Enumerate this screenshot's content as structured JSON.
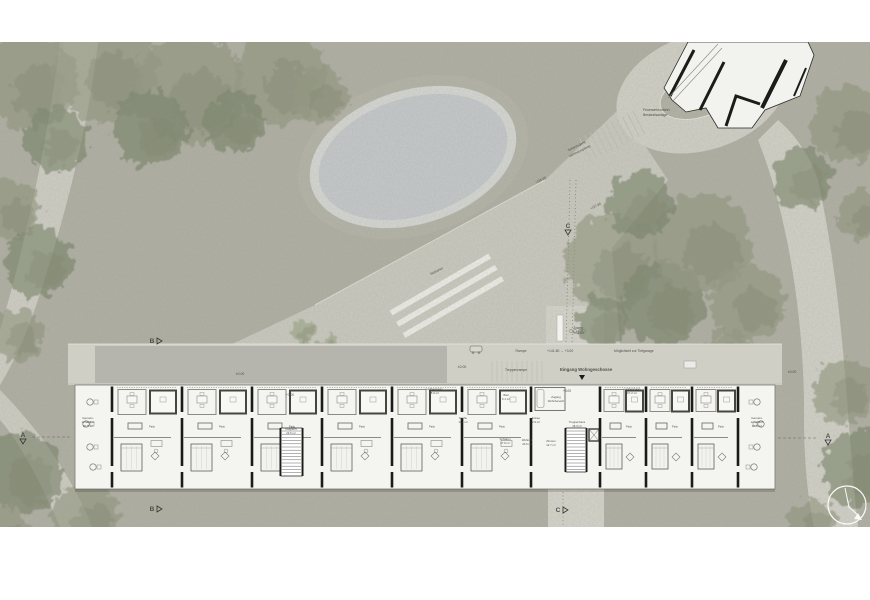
{
  "colors": {
    "ground": "#b1b0a4",
    "path": "#d2d1c8",
    "path_light": "#d6d5cc",
    "plaza": "#cbcac0",
    "pond_water": "#c6c9cc",
    "pond_rim": "#d6d8d4",
    "pond_band": "#b5b4a8",
    "tree_light": "#8d9379",
    "tree_dark": "#727e62",
    "tree_bright": "#96a07f",
    "building_fill": "#f4f4f0",
    "wall": "#1b1b18",
    "furniture": "#60605a",
    "label": "#50504a",
    "white": "#f6f6f2"
  },
  "site_labels": [
    {
      "t": "Seitenzugang",
      "x": 577,
      "y": 147,
      "r": -27,
      "s": 3.2
    },
    {
      "t": "Verbindungsweg",
      "x": 580,
      "y": 152,
      "r": -27,
      "s": 3.2
    },
    {
      "t": "Feuerwehrzufahrt",
      "x": 643,
      "y": 111,
      "s": 3.4,
      "a": "start"
    },
    {
      "t": "Bestandsanlage",
      "x": 643,
      "y": 116,
      "s": 3.4,
      "a": "start"
    },
    {
      "t": "+136.80",
      "x": 541,
      "y": 181,
      "r": -27,
      "s": 3.2
    },
    {
      "t": "+137.80",
      "x": 596,
      "y": 207,
      "r": -27,
      "s": 3.2
    },
    {
      "t": "Sitzbänke",
      "x": 437,
      "y": 272,
      "r": -27,
      "s": 3.2
    },
    {
      "t": "Zuweg",
      "x": 578,
      "y": 329,
      "s": 3.2
    },
    {
      "t": "+141.50",
      "x": 578,
      "y": 334,
      "s": 3.2
    },
    {
      "t": "Rampe",
      "x": 521,
      "y": 352,
      "s": 3.4
    },
    {
      "t": "+141.80 → +3.00",
      "x": 547,
      "y": 352,
      "s": 3.4,
      "a": "start"
    },
    {
      "t": "Möglichkeit zur Tiefgarage",
      "x": 614,
      "y": 352,
      "s": 3.4,
      "a": "start"
    },
    {
      "t": "Treppenrampe",
      "x": 516,
      "y": 371,
      "s": 3.4
    },
    {
      "t": "Eingang Wohngeschosse",
      "x": 560,
      "y": 371,
      "s": 4.3,
      "a": "start",
      "w": 600
    },
    {
      "t": "±0.00",
      "x": 240,
      "y": 375,
      "s": 3.4
    },
    {
      "t": "±0.00",
      "x": 462,
      "y": 368,
      "s": 3.4
    },
    {
      "t": "±0.00",
      "x": 792,
      "y": 373,
      "s": 3.4
    },
    {
      "t": "+3.00",
      "x": 290,
      "y": 396,
      "s": 3.2
    },
    {
      "t": "+3.00",
      "x": 567,
      "y": 392,
      "s": 3.2
    }
  ],
  "room_labels": [
    {
      "t": "Gemein-",
      "x": 88,
      "y": 419,
      "s": 3
    },
    {
      "t": "schaftlich",
      "x": 88,
      "y": 423,
      "s": 3
    },
    {
      "t": "30.5 m²",
      "x": 88,
      "y": 427,
      "s": 3
    },
    {
      "t": "Gemein-",
      "x": 757,
      "y": 419,
      "s": 3
    },
    {
      "t": "schaftlich",
      "x": 757,
      "y": 423,
      "s": 3
    },
    {
      "t": "30.5 m²",
      "x": 757,
      "y": 427,
      "s": 3
    },
    {
      "t": "Laubengang",
      "x": 434,
      "y": 390,
      "s": 3
    },
    {
      "t": "88.9 m²",
      "x": 434,
      "y": 394,
      "s": 3
    },
    {
      "t": "Laubengang",
      "x": 632,
      "y": 390,
      "s": 3
    },
    {
      "t": "37.2 m²",
      "x": 632,
      "y": 394,
      "s": 3
    },
    {
      "t": "Bad",
      "x": 506,
      "y": 396,
      "s": 2.8
    },
    {
      "t": "5.1 m²",
      "x": 506,
      "y": 400,
      "s": 2.8
    },
    {
      "t": "Küche",
      "x": 463,
      "y": 419,
      "s": 2.8
    },
    {
      "t": "11.4 m²",
      "x": 463,
      "y": 423,
      "s": 2.8
    },
    {
      "t": "Entree",
      "x": 536,
      "y": 419,
      "s": 2.8
    },
    {
      "t": "2.9 m²",
      "x": 536,
      "y": 423,
      "s": 2.8
    },
    {
      "t": "Zugang",
      "x": 556,
      "y": 398,
      "s": 2.8
    },
    {
      "t": "Wohnbereich",
      "x": 556,
      "y": 402,
      "s": 2.8
    },
    {
      "t": "Treppenhaus",
      "x": 577,
      "y": 423,
      "s": 2.8
    },
    {
      "t": "18.3 m²",
      "x": 577,
      "y": 427,
      "s": 2.8
    },
    {
      "t": "Treppenh.",
      "x": 291,
      "y": 430,
      "s": 2.8
    },
    {
      "t": "23.5 m²",
      "x": 291,
      "y": 434,
      "s": 2.8
    },
    {
      "t": "Schlafen",
      "x": 505,
      "y": 440,
      "s": 2.8
    },
    {
      "t": "17.6 m²",
      "x": 505,
      "y": 444,
      "s": 2.8
    },
    {
      "t": "Wohnen",
      "x": 527,
      "y": 441,
      "s": 2.8
    },
    {
      "t": "20.6 m²",
      "x": 527,
      "y": 445,
      "s": 2.8
    },
    {
      "t": "Zimmer",
      "x": 551,
      "y": 442,
      "s": 2.8
    },
    {
      "t": "12.7 m²",
      "x": 551,
      "y": 446,
      "s": 2.8
    }
  ],
  "section_markers": [
    {
      "l": "A",
      "x": 23,
      "y": 437,
      "tri": "down",
      "line": [
        32,
        437,
        72,
        437
      ]
    },
    {
      "l": "A",
      "x": 828,
      "y": 438,
      "tri": "down",
      "line": [
        778,
        438,
        818,
        438
      ]
    },
    {
      "l": "B",
      "x": 152,
      "y": 343,
      "tri": "right"
    },
    {
      "l": "B",
      "x": 152,
      "y": 511,
      "tri": "right"
    },
    {
      "l": "C",
      "x": 568,
      "y": 228,
      "tri": "down"
    },
    {
      "l": "C",
      "x": 558,
      "y": 512,
      "tri": "right"
    }
  ],
  "building": {
    "patio_label": "Patio",
    "left_units": [
      112,
      182,
      252,
      322,
      392,
      462
    ],
    "left_unit_width": 69,
    "right_units": [
      600,
      646,
      692
    ],
    "right_unit_width": 46,
    "wall_xs": [
      112,
      182,
      252,
      322,
      392,
      462,
      531,
      600,
      646,
      692,
      738
    ]
  },
  "trees": [
    {
      "x": 30,
      "y": 80,
      "r": 48,
      "d": 0
    },
    {
      "x": 105,
      "y": 70,
      "r": 52,
      "d": 0
    },
    {
      "x": 190,
      "y": 90,
      "r": 55,
      "d": 0
    },
    {
      "x": 280,
      "y": 78,
      "r": 46,
      "d": 0
    },
    {
      "x": 150,
      "y": 128,
      "r": 38,
      "d": 1
    },
    {
      "x": 55,
      "y": 140,
      "r": 32,
      "d": 1
    },
    {
      "x": 235,
      "y": 122,
      "r": 30,
      "d": 1
    },
    {
      "x": 320,
      "y": 95,
      "r": 28,
      "d": 0
    },
    {
      "x": 12,
      "y": 210,
      "r": 30,
      "d": 0
    },
    {
      "x": 38,
      "y": 262,
      "r": 34,
      "d": 1
    },
    {
      "x": 18,
      "y": 335,
      "r": 26,
      "d": 0
    },
    {
      "x": 303,
      "y": 333,
      "r": 13,
      "d": 2
    },
    {
      "x": 330,
      "y": 345,
      "r": 11,
      "d": 2
    },
    {
      "x": 612,
      "y": 262,
      "r": 48,
      "d": 0
    },
    {
      "x": 663,
      "y": 302,
      "r": 42,
      "d": 1
    },
    {
      "x": 702,
      "y": 242,
      "r": 50,
      "d": 0
    },
    {
      "x": 748,
      "y": 302,
      "r": 38,
      "d": 0
    },
    {
      "x": 640,
      "y": 205,
      "r": 33,
      "d": 1
    },
    {
      "x": 603,
      "y": 322,
      "r": 26,
      "d": 1
    },
    {
      "x": 728,
      "y": 352,
      "r": 22,
      "d": 0
    },
    {
      "x": 848,
      "y": 125,
      "r": 38,
      "d": 0
    },
    {
      "x": 802,
      "y": 178,
      "r": 30,
      "d": 1
    },
    {
      "x": 862,
      "y": 215,
      "r": 26,
      "d": 0
    },
    {
      "x": 760,
      "y": 62,
      "r": 20,
      "d": 0
    },
    {
      "x": 845,
      "y": 392,
      "r": 32,
      "d": 0
    },
    {
      "x": 860,
      "y": 468,
      "r": 38,
      "d": 1
    },
    {
      "x": 812,
      "y": 522,
      "r": 24,
      "d": 0
    },
    {
      "x": 22,
      "y": 472,
      "r": 40,
      "d": 1
    },
    {
      "x": 85,
      "y": 516,
      "r": 34,
      "d": 0
    },
    {
      "x": 2,
      "y": 535,
      "r": 28,
      "d": 0
    },
    {
      "x": 688,
      "y": 362,
      "r": 15,
      "d": 1
    }
  ]
}
